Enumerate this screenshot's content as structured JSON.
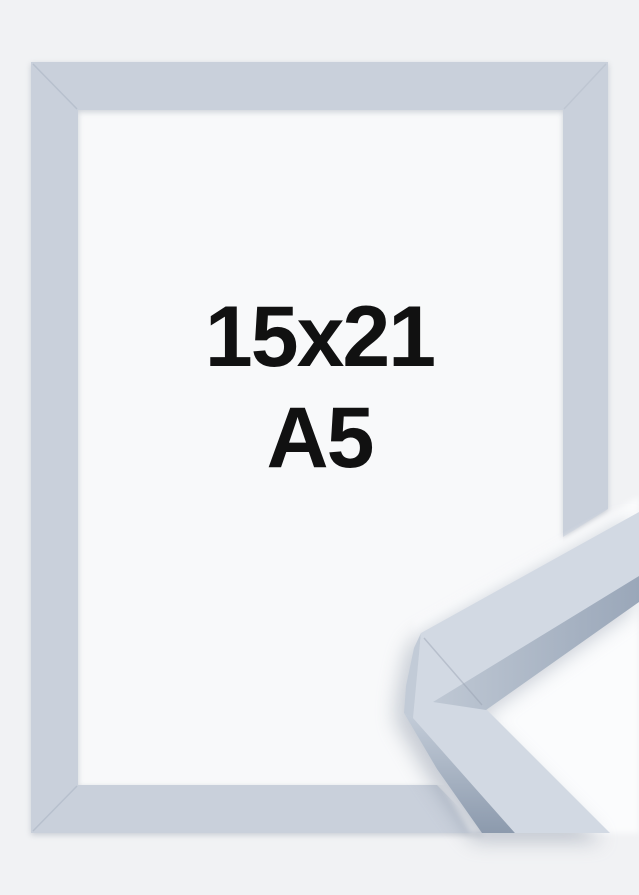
{
  "product_image": {
    "size_label": {
      "line1": "15x21",
      "line2": "A5"
    },
    "colors": {
      "page_background": "#f1f2f4",
      "frame_front": "#c9d0db",
      "opening_white": "#f8f9fa",
      "label_text": "#111111",
      "detail_backdrop": "#fbfcfd",
      "detail_top_face": "#d2d9e3",
      "detail_bevel_light": "#bfc8d4",
      "detail_bevel_dark": "#9aa7b9",
      "detail_side_light": "#c4cdd9",
      "detail_side_dark": "#8c9aad",
      "detail_end_cap": "#c2cbd7"
    }
  }
}
